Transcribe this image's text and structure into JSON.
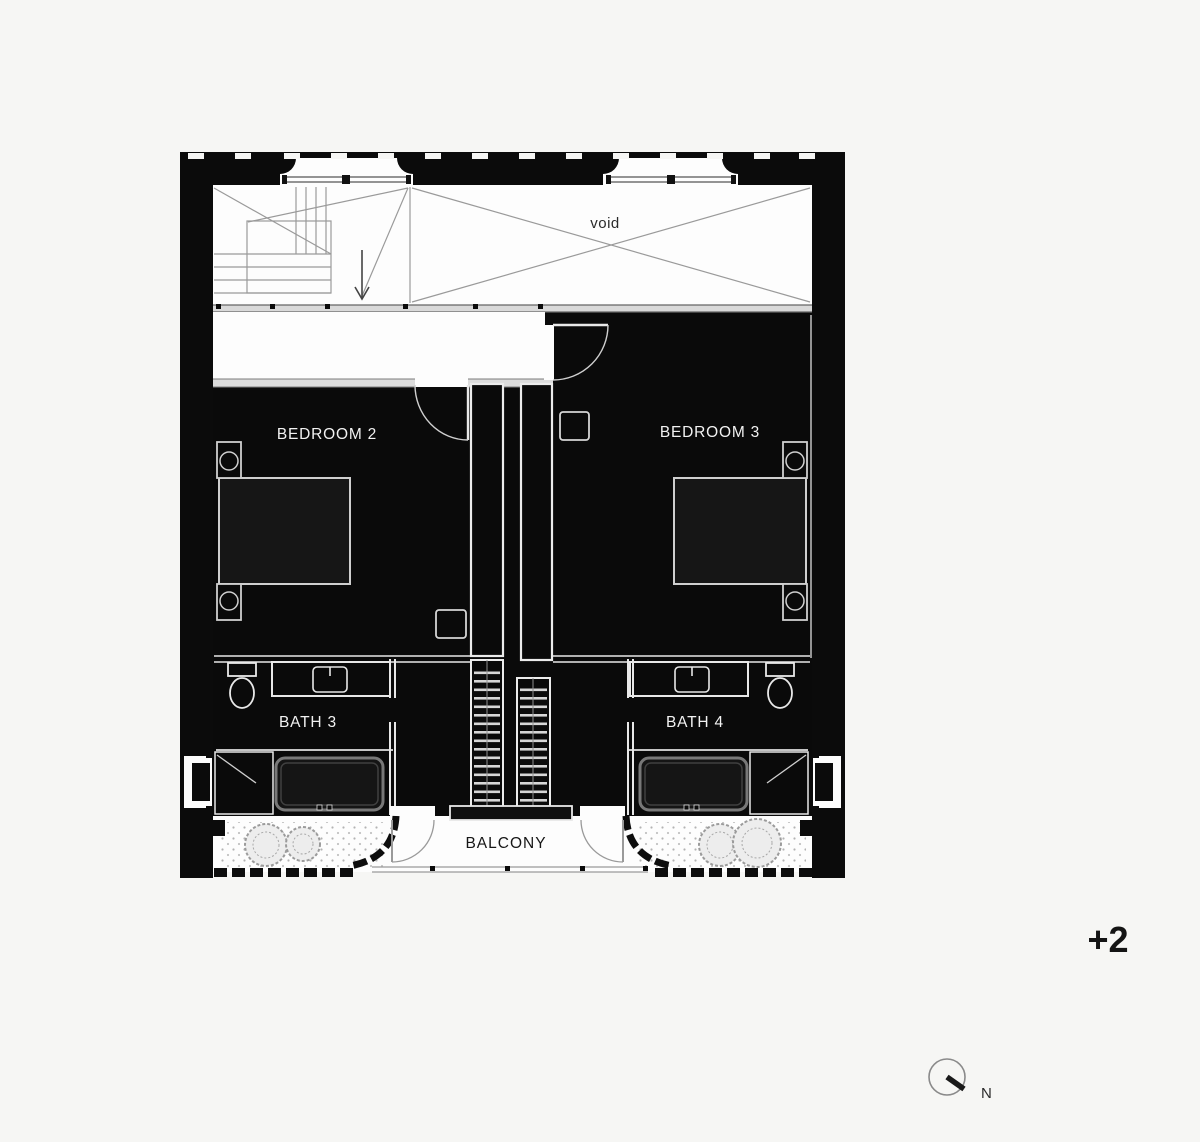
{
  "plan": {
    "labels": {
      "void": "void",
      "bedroom2": "BEDROOM 2",
      "bedroom3": "BEDROOM 3",
      "bath3": "BATH 3",
      "bath4": "BATH 4",
      "balcony": "BALCONY",
      "level": "+2",
      "north": "N"
    },
    "colors": {
      "paper": "#f6f6f4",
      "wall": "#0b0b0b",
      "room_fill": "#0a0a0a",
      "cad_line": "#9a9a9a",
      "fixture_line": "#e8e8e8",
      "label_light": "#f2f2f2",
      "label_dark": "#1c1c1c"
    }
  }
}
